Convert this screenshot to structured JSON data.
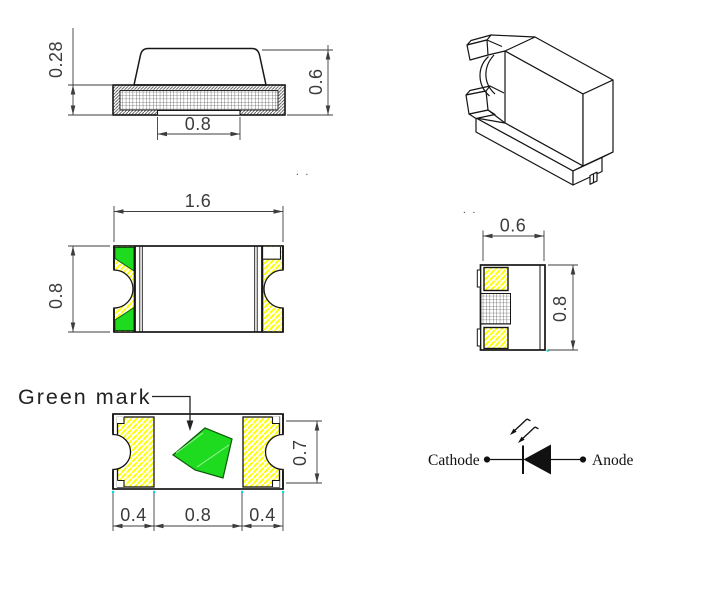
{
  "drawing": {
    "side_view": {
      "base_height": "0.28",
      "total_height": "0.6",
      "notch_width": "0.8"
    },
    "top_view": {
      "length": "1.6",
      "width": "0.8"
    },
    "end_view": {
      "width": "0.6",
      "height": "0.8"
    },
    "bottom_view": {
      "green_mark_label": "Green mark",
      "left_pad": "0.4",
      "center_gap": "0.8",
      "right_pad": "0.4",
      "height": "0.7"
    },
    "circuit_symbol": {
      "cathode": "Cathode",
      "anode": "Anode"
    },
    "artifacts": {
      "dots_a": ". .",
      "dots_b": ". ."
    },
    "colors": {
      "green_mark": "#1fdb1f",
      "green_edge": "#0a570a",
      "green_inner_line": "#9cf59c",
      "hatch_yellow": "#ffff00",
      "outline": "#161616",
      "dim": "#3d3d3d",
      "cyan_marker": "#00e0e0"
    }
  }
}
